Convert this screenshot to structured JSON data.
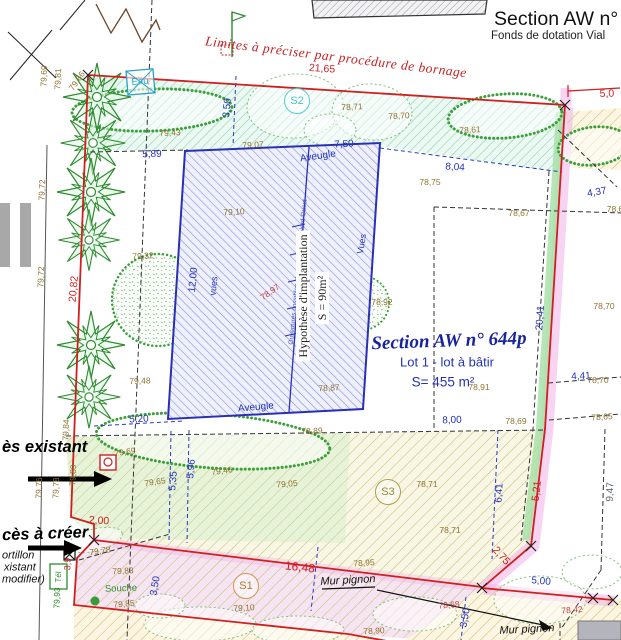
{
  "header": {
    "title": "Section AW n°",
    "subtitle": "Fonds de dotation Vial"
  },
  "colors": {
    "boundary_red": "#cf1f1f",
    "dimension_blue": "#2233b8",
    "elevation_olive": "#8f7230",
    "vegetation_green": "#2e8b2e",
    "zone_pink": "#f0a9e4",
    "building_blue": "#2a2fb5"
  },
  "labels": [
    {
      "t": "Limites à préciser par procédure de bornage",
      "x": 336,
      "y": 57,
      "r": 7,
      "c": "serif-red",
      "n": "boundary-note"
    },
    {
      "t": "21,65",
      "x": 322,
      "y": 69,
      "r": 4,
      "c": "dimr",
      "n": "dimension"
    },
    {
      "t": "5,0",
      "x": 607,
      "y": 94,
      "r": -2,
      "c": "dimr",
      "n": "dimension"
    },
    {
      "t": "20,82",
      "x": 74,
      "y": 289,
      "r": -85,
      "c": "dimr",
      "n": "dimension"
    },
    {
      "t": "2,00",
      "x": 99,
      "y": 521,
      "r": 4,
      "c": "dimr",
      "n": "dimension"
    },
    {
      "t": "16,48",
      "x": 300,
      "y": 567,
      "r": 6,
      "c": "dimr",
      "s": 12,
      "n": "dimension"
    },
    {
      "t": "2,75",
      "x": 501,
      "y": 556,
      "r": 48,
      "c": "dimr",
      "n": "dimension"
    },
    {
      "t": "5,21",
      "x": 537,
      "y": 491,
      "r": -84,
      "c": "dimr",
      "n": "dimension"
    },
    {
      "t": "3,9",
      "x": 68,
      "y": 564,
      "r": -88,
      "c": "dimr",
      "s": 9,
      "n": "dimension"
    },
    {
      "t": "5,89",
      "x": 152,
      "y": 155,
      "r": -2,
      "c": "dim",
      "n": "dimension"
    },
    {
      "t": "7,50",
      "x": 344,
      "y": 145,
      "r": -3,
      "c": "dim",
      "n": "dimension"
    },
    {
      "t": "3,50",
      "x": 228,
      "y": 108,
      "r": -85,
      "c": "dim",
      "n": "dimension"
    },
    {
      "t": "8,04",
      "x": 455,
      "y": 168,
      "r": 4,
      "c": "dim",
      "n": "dimension"
    },
    {
      "t": "4,37",
      "x": 597,
      "y": 193,
      "r": -10,
      "c": "dim",
      "n": "dimension"
    },
    {
      "t": "12,00",
      "x": 194,
      "y": 280,
      "r": -85,
      "c": "dim",
      "n": "dimension"
    },
    {
      "t": "20,41",
      "x": 541,
      "y": 318,
      "r": -86,
      "c": "dim",
      "n": "dimension"
    },
    {
      "t": "4,41",
      "x": 581,
      "y": 377,
      "r": -3,
      "c": "dim",
      "n": "dimension"
    },
    {
      "t": "8,00",
      "x": 452,
      "y": 421,
      "r": -2,
      "c": "dim",
      "n": "dimension"
    },
    {
      "t": "5,20",
      "x": 139,
      "y": 420,
      "r": -3,
      "c": "dim",
      "n": "dimension"
    },
    {
      "t": "5,35",
      "x": 174,
      "y": 481,
      "r": -85,
      "c": "dim",
      "n": "dimension"
    },
    {
      "t": "5,96",
      "x": 192,
      "y": 469,
      "r": -85,
      "c": "dim",
      "n": "dimension"
    },
    {
      "t": "6,41",
      "x": 500,
      "y": 493,
      "r": -87,
      "c": "dim",
      "n": "dimension"
    },
    {
      "t": "3,50",
      "x": 156,
      "y": 586,
      "r": -80,
      "c": "dim",
      "n": "dimension"
    },
    {
      "t": "3,50",
      "x": 466,
      "y": 618,
      "r": -80,
      "c": "dim",
      "n": "dimension"
    },
    {
      "t": "5,00",
      "x": 541,
      "y": 582,
      "r": 5,
      "c": "dim",
      "n": "dimension"
    },
    {
      "t": "9,47",
      "x": 611,
      "y": 492,
      "r": -88,
      "c": "dim g9",
      "n": "dimension"
    },
    {
      "t": "Aveugle",
      "x": 318,
      "y": 157,
      "r": -8,
      "c": "ave",
      "n": "facade-note"
    },
    {
      "t": "Aveugle",
      "x": 256,
      "y": 408,
      "r": -5,
      "c": "ave",
      "n": "facade-note"
    },
    {
      "t": "vues",
      "x": 214,
      "y": 286,
      "r": -84,
      "c": "vues",
      "n": "facade-note"
    },
    {
      "t": "Vues",
      "x": 362,
      "y": 244,
      "r": -80,
      "c": "vues",
      "n": "facade-note"
    },
    {
      "t": "Ouvertures possibles et parties vitrées Nord-Ouest",
      "x": 299,
      "y": 272,
      "r": -84.5,
      "c": "tiny",
      "n": "building-orientation-note"
    },
    {
      "t": "Hypothèse d'implantation",
      "x": 303,
      "y": 296,
      "r": -90,
      "c": "impl",
      "n": "building-hypothesis-label"
    },
    {
      "t": "S = 90m²",
      "x": 322,
      "y": 298,
      "r": -90,
      "c": "impl",
      "n": "building-area-label"
    },
    {
      "t": "Section AW n° 644p",
      "x": 449,
      "y": 341,
      "r": -2,
      "c": "sec644",
      "n": "parcel-title"
    },
    {
      "t": "Lot 1 - lot à bâtir",
      "x": 447,
      "y": 362,
      "r": 0,
      "c": "lot",
      "n": "lot-label"
    },
    {
      "t": "S= 455 m²",
      "x": 443,
      "y": 382,
      "r": 0,
      "c": "surf",
      "n": "lot-area"
    },
    {
      "t": "S2",
      "x": 297,
      "y": 101,
      "r": 0,
      "c": "zone z2",
      "n": "zone-s2"
    },
    {
      "t": "S3",
      "x": 388,
      "y": 492,
      "r": 0,
      "c": "zone z3",
      "n": "zone-s3"
    },
    {
      "t": "S1",
      "x": 246,
      "y": 586,
      "r": 0,
      "c": "zone z1",
      "n": "zone-s1"
    },
    {
      "t": "Eau",
      "x": 140,
      "y": 82,
      "r": -4,
      "c": "cyan",
      "n": "water-label"
    },
    {
      "t": "Souche",
      "x": 121,
      "y": 589,
      "r": -2,
      "c": "grn",
      "n": "stump-label"
    },
    {
      "t": "79,93",
      "x": 57,
      "y": 598,
      "r": -88,
      "c": "grn",
      "s": 8.5,
      "n": "spot-elevation"
    },
    {
      "t": "Tél",
      "x": 59,
      "y": 577,
      "r": -88,
      "c": "grn",
      "s": 8,
      "n": "telecom-label"
    },
    {
      "t": "ès existant",
      "x": 2,
      "y": 447,
      "r": 0,
      "c": "acc",
      "a": "l",
      "n": "access-existing-label"
    },
    {
      "t": "cès à créer",
      "x": 2,
      "y": 534,
      "r": -2,
      "c": "acc",
      "a": "l",
      "n": "access-create-label"
    },
    {
      "t": "ortillon",
      "x": 2,
      "y": 556,
      "r": 0,
      "c": "port",
      "a": "l",
      "n": "gate-note"
    },
    {
      "t": "xistant",
      "x": 4,
      "y": 568,
      "r": 0,
      "c": "port",
      "a": "l",
      "n": "gate-note"
    },
    {
      "t": "modifier)",
      "x": 2,
      "y": 580,
      "r": 0,
      "c": "port",
      "a": "l",
      "n": "gate-note"
    },
    {
      "t": "Mur pignon",
      "x": 348,
      "y": 581,
      "r": -3,
      "c": "mur",
      "n": "gable-wall-label"
    },
    {
      "t": "Mur pignon",
      "x": 527,
      "y": 630,
      "r": -3,
      "c": "mur",
      "n": "gable-wall-label"
    },
    {
      "t": "79,69",
      "x": 44,
      "y": 76,
      "r": -88,
      "c": "elev",
      "n": "spot-elevation"
    },
    {
      "t": "79,81",
      "x": 58,
      "y": 79,
      "r": -88,
      "c": "elev",
      "n": "spot-elevation"
    },
    {
      "t": "79,66",
      "x": 77,
      "y": 81,
      "r": -55,
      "c": "elev",
      "n": "spot-elevation"
    },
    {
      "t": "79,72",
      "x": 42,
      "y": 190,
      "r": -88,
      "c": "elev",
      "n": "spot-elevation"
    },
    {
      "t": "79,72",
      "x": 41,
      "y": 277,
      "r": -88,
      "c": "elev",
      "n": "spot-elevation"
    },
    {
      "t": "79,84",
      "x": 66,
      "y": 430,
      "r": -88,
      "c": "elev",
      "n": "spot-elevation"
    },
    {
      "t": "79,89",
      "x": 73,
      "y": 475,
      "r": -88,
      "c": "elev",
      "n": "spot-elevation"
    },
    {
      "t": "79,76",
      "x": 39,
      "y": 488,
      "r": -88,
      "c": "elev",
      "n": "spot-elevation"
    },
    {
      "t": "79,78",
      "x": 56,
      "y": 488,
      "r": -88,
      "c": "elev",
      "n": "spot-elevation"
    },
    {
      "t": "79,43",
      "x": 170,
      "y": 133,
      "r": -3,
      "c": "elev",
      "n": "spot-elevation"
    },
    {
      "t": "79,07",
      "x": 253,
      "y": 145,
      "r": -3,
      "c": "elev",
      "n": "spot-elevation"
    },
    {
      "t": "78,71",
      "x": 352,
      "y": 107,
      "r": -3,
      "c": "elev",
      "n": "spot-elevation"
    },
    {
      "t": "78,70",
      "x": 399,
      "y": 116,
      "r": -3,
      "c": "elev",
      "n": "spot-elevation"
    },
    {
      "t": "78,61",
      "x": 470,
      "y": 130,
      "r": -3,
      "c": "elev",
      "n": "spot-elevation"
    },
    {
      "t": "78,75",
      "x": 430,
      "y": 182,
      "r": 0,
      "c": "elev",
      "n": "spot-elevation"
    },
    {
      "t": "78,67",
      "x": 519,
      "y": 213,
      "r": 0,
      "c": "elev",
      "n": "spot-elevation"
    },
    {
      "t": "78,6",
      "x": 615,
      "y": 209,
      "r": 0,
      "c": "elev",
      "n": "spot-elevation"
    },
    {
      "t": "78,70",
      "x": 604,
      "y": 306,
      "r": 0,
      "c": "elev",
      "n": "spot-elevation"
    },
    {
      "t": "78,70",
      "x": 598,
      "y": 380,
      "r": 0,
      "c": "elev",
      "n": "spot-elevation"
    },
    {
      "t": "78,65",
      "x": 602,
      "y": 417,
      "r": -4,
      "c": "elev",
      "n": "spot-elevation"
    },
    {
      "t": "78,69",
      "x": 516,
      "y": 421,
      "r": 0,
      "c": "elev",
      "n": "spot-elevation"
    },
    {
      "t": "78,91",
      "x": 479,
      "y": 387,
      "r": 0,
      "c": "elev",
      "n": "spot-elevation"
    },
    {
      "t": "78,89",
      "x": 312,
      "y": 431,
      "r": -2,
      "c": "elev",
      "n": "spot-elevation"
    },
    {
      "t": "79,32",
      "x": 143,
      "y": 256,
      "r": -3,
      "c": "elev",
      "n": "spot-elevation"
    },
    {
      "t": "79,10",
      "x": 234,
      "y": 212,
      "r": -3,
      "c": "elev",
      "n": "spot-elevation"
    },
    {
      "t": "78,97",
      "x": 270,
      "y": 292,
      "r": -35,
      "c": "elev-red",
      "n": "spot-elevation"
    },
    {
      "t": "78,87",
      "x": 329,
      "y": 388,
      "r": -3,
      "c": "elev",
      "n": "spot-elevation"
    },
    {
      "t": "78,92",
      "x": 382,
      "y": 302,
      "r": 0,
      "c": "elev",
      "n": "spot-elevation"
    },
    {
      "t": "79,48",
      "x": 140,
      "y": 381,
      "r": -2,
      "c": "elev",
      "n": "spot-elevation"
    },
    {
      "t": "79,69",
      "x": 125,
      "y": 452,
      "r": -8,
      "c": "elev",
      "n": "spot-elevation"
    },
    {
      "t": "79,65",
      "x": 155,
      "y": 482,
      "r": -8,
      "c": "elev",
      "n": "spot-elevation"
    },
    {
      "t": "79,46",
      "x": 222,
      "y": 471,
      "r": -8,
      "c": "elev",
      "n": "spot-elevation"
    },
    {
      "t": "79,05",
      "x": 287,
      "y": 484,
      "r": -5,
      "c": "elev",
      "n": "spot-elevation"
    },
    {
      "t": "78,71",
      "x": 427,
      "y": 484,
      "r": 0,
      "c": "elev",
      "n": "spot-elevation"
    },
    {
      "t": "78,71",
      "x": 450,
      "y": 530,
      "r": 0,
      "c": "elev",
      "n": "spot-elevation"
    },
    {
      "t": "78,95",
      "x": 364,
      "y": 563,
      "r": -4,
      "c": "elev",
      "n": "spot-elevation"
    },
    {
      "t": "79,78",
      "x": 100,
      "y": 551,
      "r": -8,
      "c": "elev",
      "n": "spot-elevation"
    },
    {
      "t": "79,83",
      "x": 123,
      "y": 571,
      "r": -3,
      "c": "elev",
      "n": "spot-elevation"
    },
    {
      "t": "79,85",
      "x": 124,
      "y": 604,
      "r": -5,
      "c": "elev",
      "n": "spot-elevation"
    },
    {
      "t": "79,10",
      "x": 244,
      "y": 608,
      "r": -3,
      "c": "elev",
      "n": "spot-elevation"
    },
    {
      "t": "78,90",
      "x": 374,
      "y": 631,
      "r": -3,
      "c": "elev",
      "n": "spot-elevation"
    },
    {
      "t": "78,68",
      "x": 449,
      "y": 605,
      "r": -5,
      "c": "elev-red",
      "n": "spot-elevation"
    },
    {
      "t": "78,42",
      "x": 572,
      "y": 610,
      "r": -5,
      "c": "elev-red",
      "n": "spot-elevation"
    }
  ]
}
